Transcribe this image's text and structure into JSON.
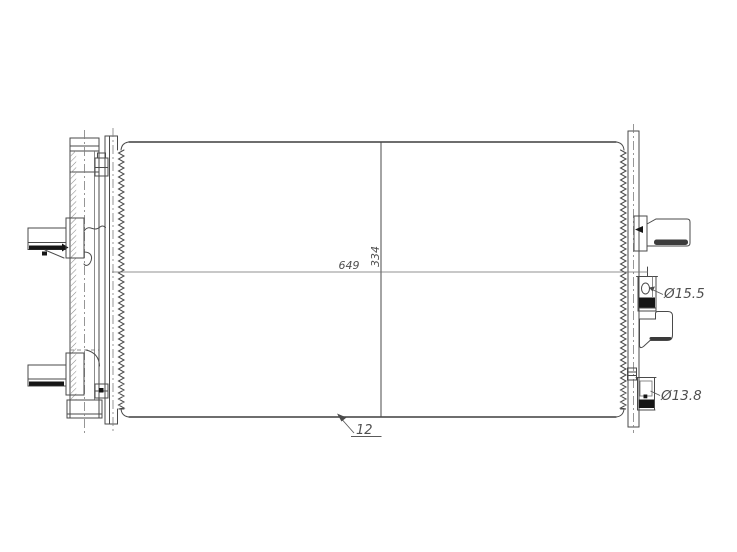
{
  "drawing": {
    "annotations": {
      "width_dim": "649",
      "height_dim": "334",
      "bottom_offset_dim": "12",
      "upper_port_diameter": "Ø15.5",
      "lower_port_diameter": "Ø13.8"
    },
    "colors": {
      "line": "#4a4a4a",
      "centerline": "#7d7d7d",
      "dark_fill": "#161616",
      "text": "#4f4f4f",
      "background": "#ffffff"
    }
  }
}
